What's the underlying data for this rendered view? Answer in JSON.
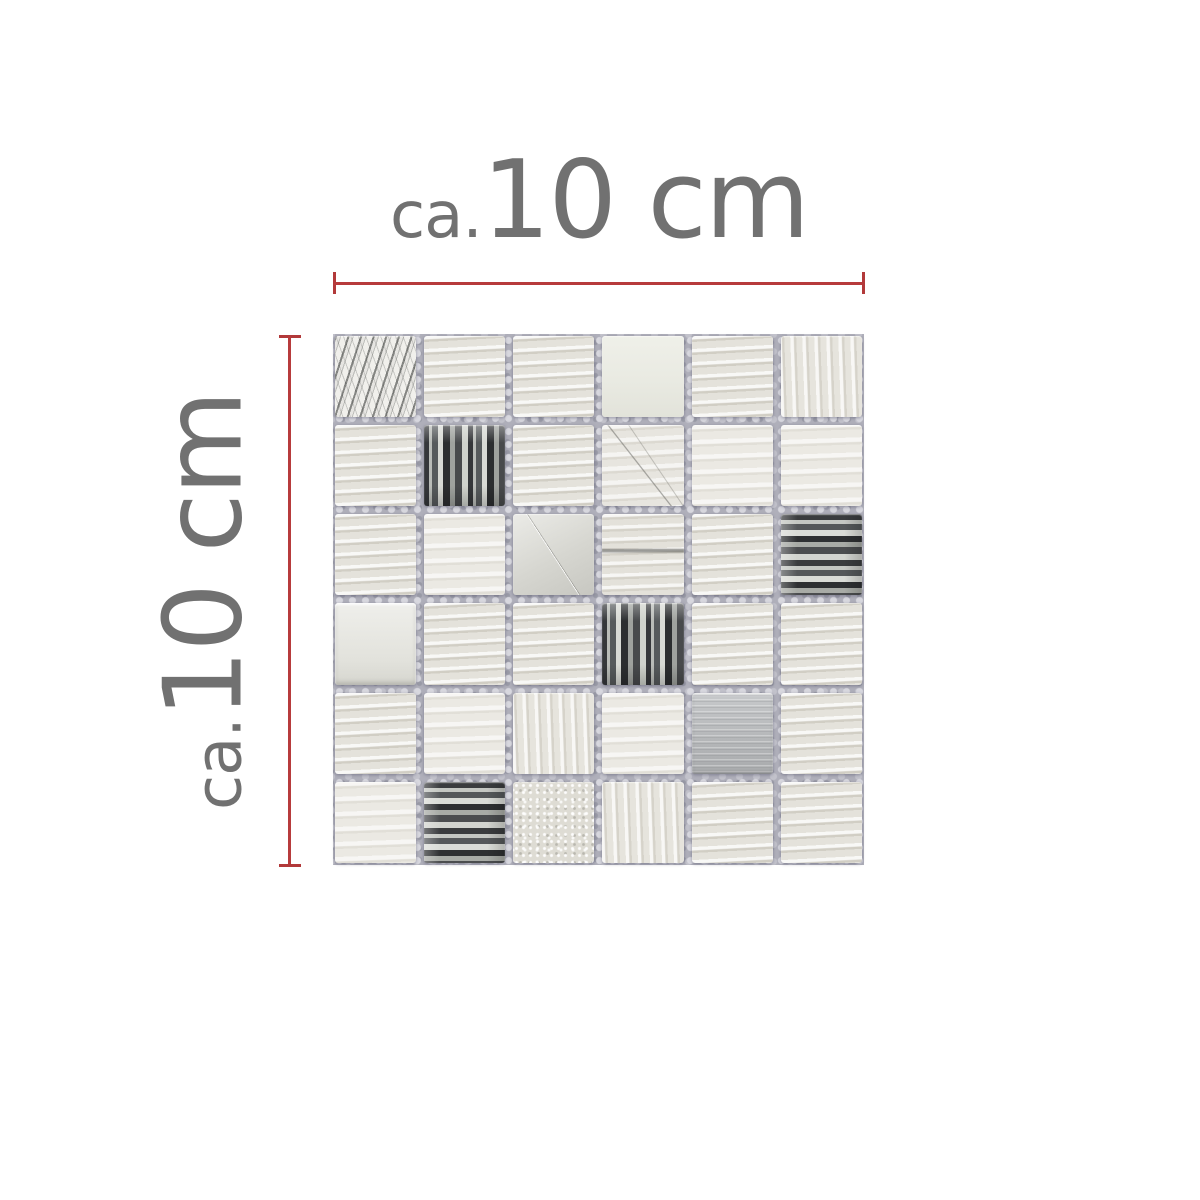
{
  "dimensions": {
    "top": {
      "prefix": "ca.",
      "value": "10 cm"
    },
    "left": {
      "prefix": "ca.",
      "value": "10 cm"
    }
  },
  "colors": {
    "label_gray": "#717171",
    "measure_red": "#b73b3c",
    "grout_gray": "#afafba",
    "background": "#ffffff"
  },
  "mosaic": {
    "rows": 6,
    "cols": 6,
    "tile_types": [
      "vein",
      "stone",
      "stone",
      "plain",
      "stone",
      "stone-v",
      "stone",
      "glass-v",
      "stone",
      "scratch",
      "stone-light",
      "stone-light",
      "stone",
      "stone-light",
      "metal-bright",
      "stone-vein",
      "stone",
      "glass-h",
      "metal-white",
      "stone",
      "stone",
      "glass-v",
      "stone",
      "stone",
      "stone",
      "stone-light",
      "stone-v",
      "stone-light",
      "metal-grey",
      "stone",
      "stone-light",
      "glass-h",
      "speckle",
      "stone-v",
      "stone",
      "stone"
    ]
  }
}
